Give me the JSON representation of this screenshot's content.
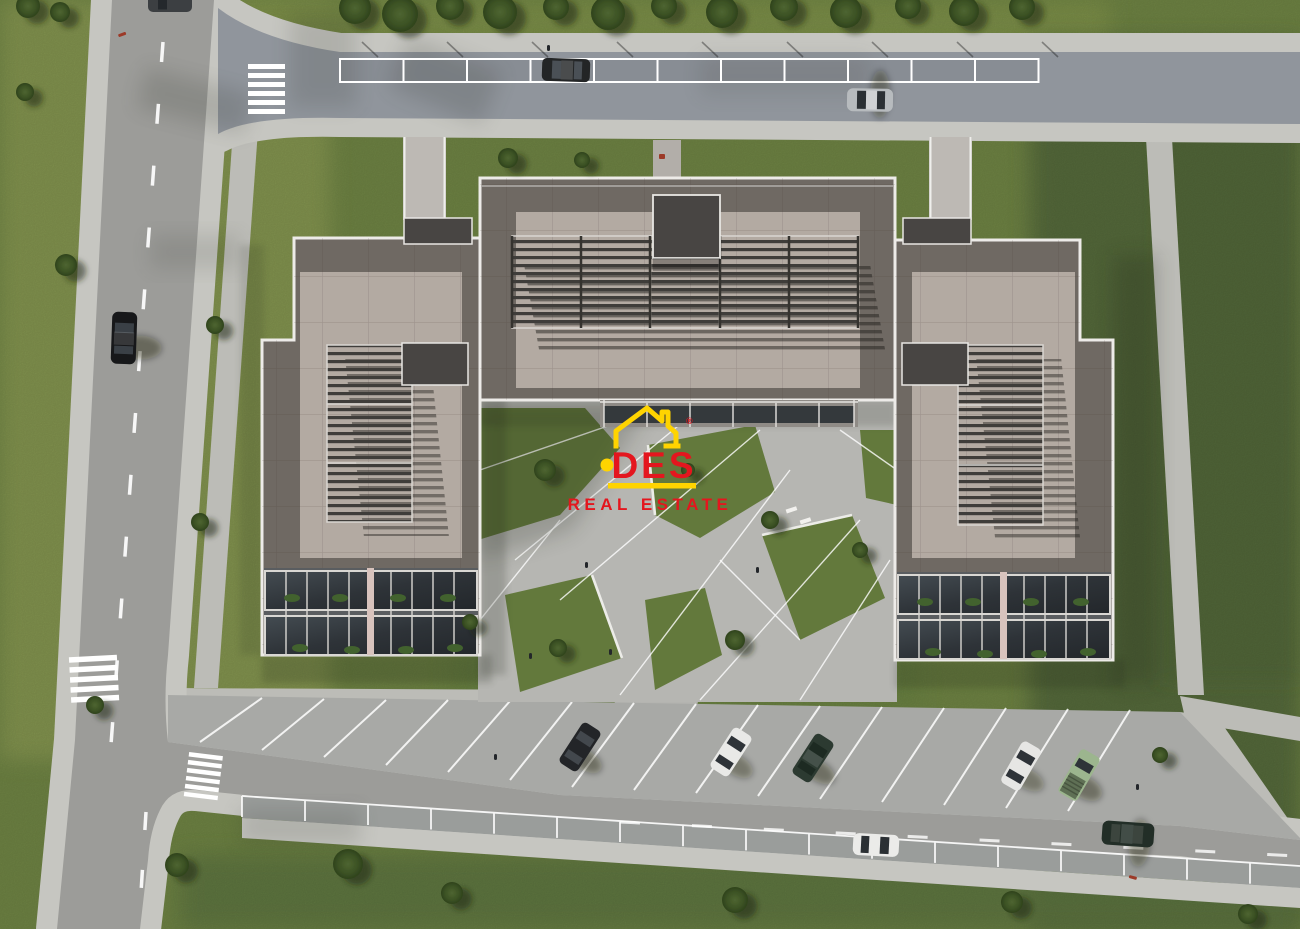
{
  "watermark": {
    "brand": "DES",
    "tagline": "REAL ESTATE",
    "registered": "®",
    "red": "#E4161E",
    "yellow": "#FFD400"
  },
  "scene": {
    "type": "aerial-3d-architectural-render",
    "subject": "top-down view of a residential complex: three flat-roofed apartment blocks around a landscaped courtyard, ring roads, street parking and lawns",
    "palette": {
      "grassBase": "#6f8444",
      "grassLight": "#8a9a52",
      "grassDark": "#52673a",
      "roadTop": "#90959c",
      "roadLeft": "#9c9c99",
      "roadBottom": "#9a9d9b",
      "parkingLot": "#a8a9a6",
      "sidewalk": "#c6c6c1",
      "gravelPath": "#bcbcb7",
      "courtyard": "#b6b6b2",
      "roofFrame": "#6f6963",
      "roofField": "#b3aaa2",
      "trim": "#edebe8",
      "roofBox": "#484543",
      "pergola": "#3f3d3a",
      "glass": "#2f3438",
      "plant": "#42622e",
      "marking": "#ffffff"
    },
    "buildings": [
      {
        "id": "left-block",
        "roof": "pergola roof deck, two balcony rows on south face"
      },
      {
        "id": "center-block",
        "roof": "wide pergola roof deck, rooftop access box"
      },
      {
        "id": "right-block",
        "roof": "pergola roof deck, two balcony rows on south face"
      }
    ],
    "cars": [
      {
        "id": "sedan-left-road",
        "color": "#17181a",
        "location": "left road, driving"
      },
      {
        "id": "car-top-edge",
        "color": "#3c3f42",
        "location": "top edge of left road"
      },
      {
        "id": "parked-suv-top-road",
        "color": "#232526",
        "location": "top road parking bay"
      },
      {
        "id": "silver-sedan-top-road",
        "color": "#b7bbbe",
        "location": "top road, driving"
      },
      {
        "id": "parked-dark-car-lot",
        "color": "#232528",
        "location": "angled stall, south lot"
      },
      {
        "id": "parked-white-car-lot",
        "color": "#e9e9e7",
        "location": "angled stall, south lot"
      },
      {
        "id": "parked-green-car-lot",
        "color": "#2c3a31",
        "location": "angled stall, south lot"
      },
      {
        "id": "parked-white-car-2",
        "color": "#e6e6e4",
        "location": "angled stall, south lot"
      },
      {
        "id": "parked-pickup-truck",
        "color": "#9cb58e",
        "location": "angled stall, south lot"
      },
      {
        "id": "white-car-bottom-road",
        "color": "#ebebe9",
        "location": "bottom road"
      },
      {
        "id": "green-car-bottom-road",
        "color": "#222e27",
        "location": "bottom road, driving"
      }
    ],
    "counts": {
      "crosswalks": 3,
      "top_road_parking_bays": 11,
      "bottom_road_parallel_bays": 17,
      "angled_parking_stalls": 15,
      "buildings": 3
    }
  }
}
